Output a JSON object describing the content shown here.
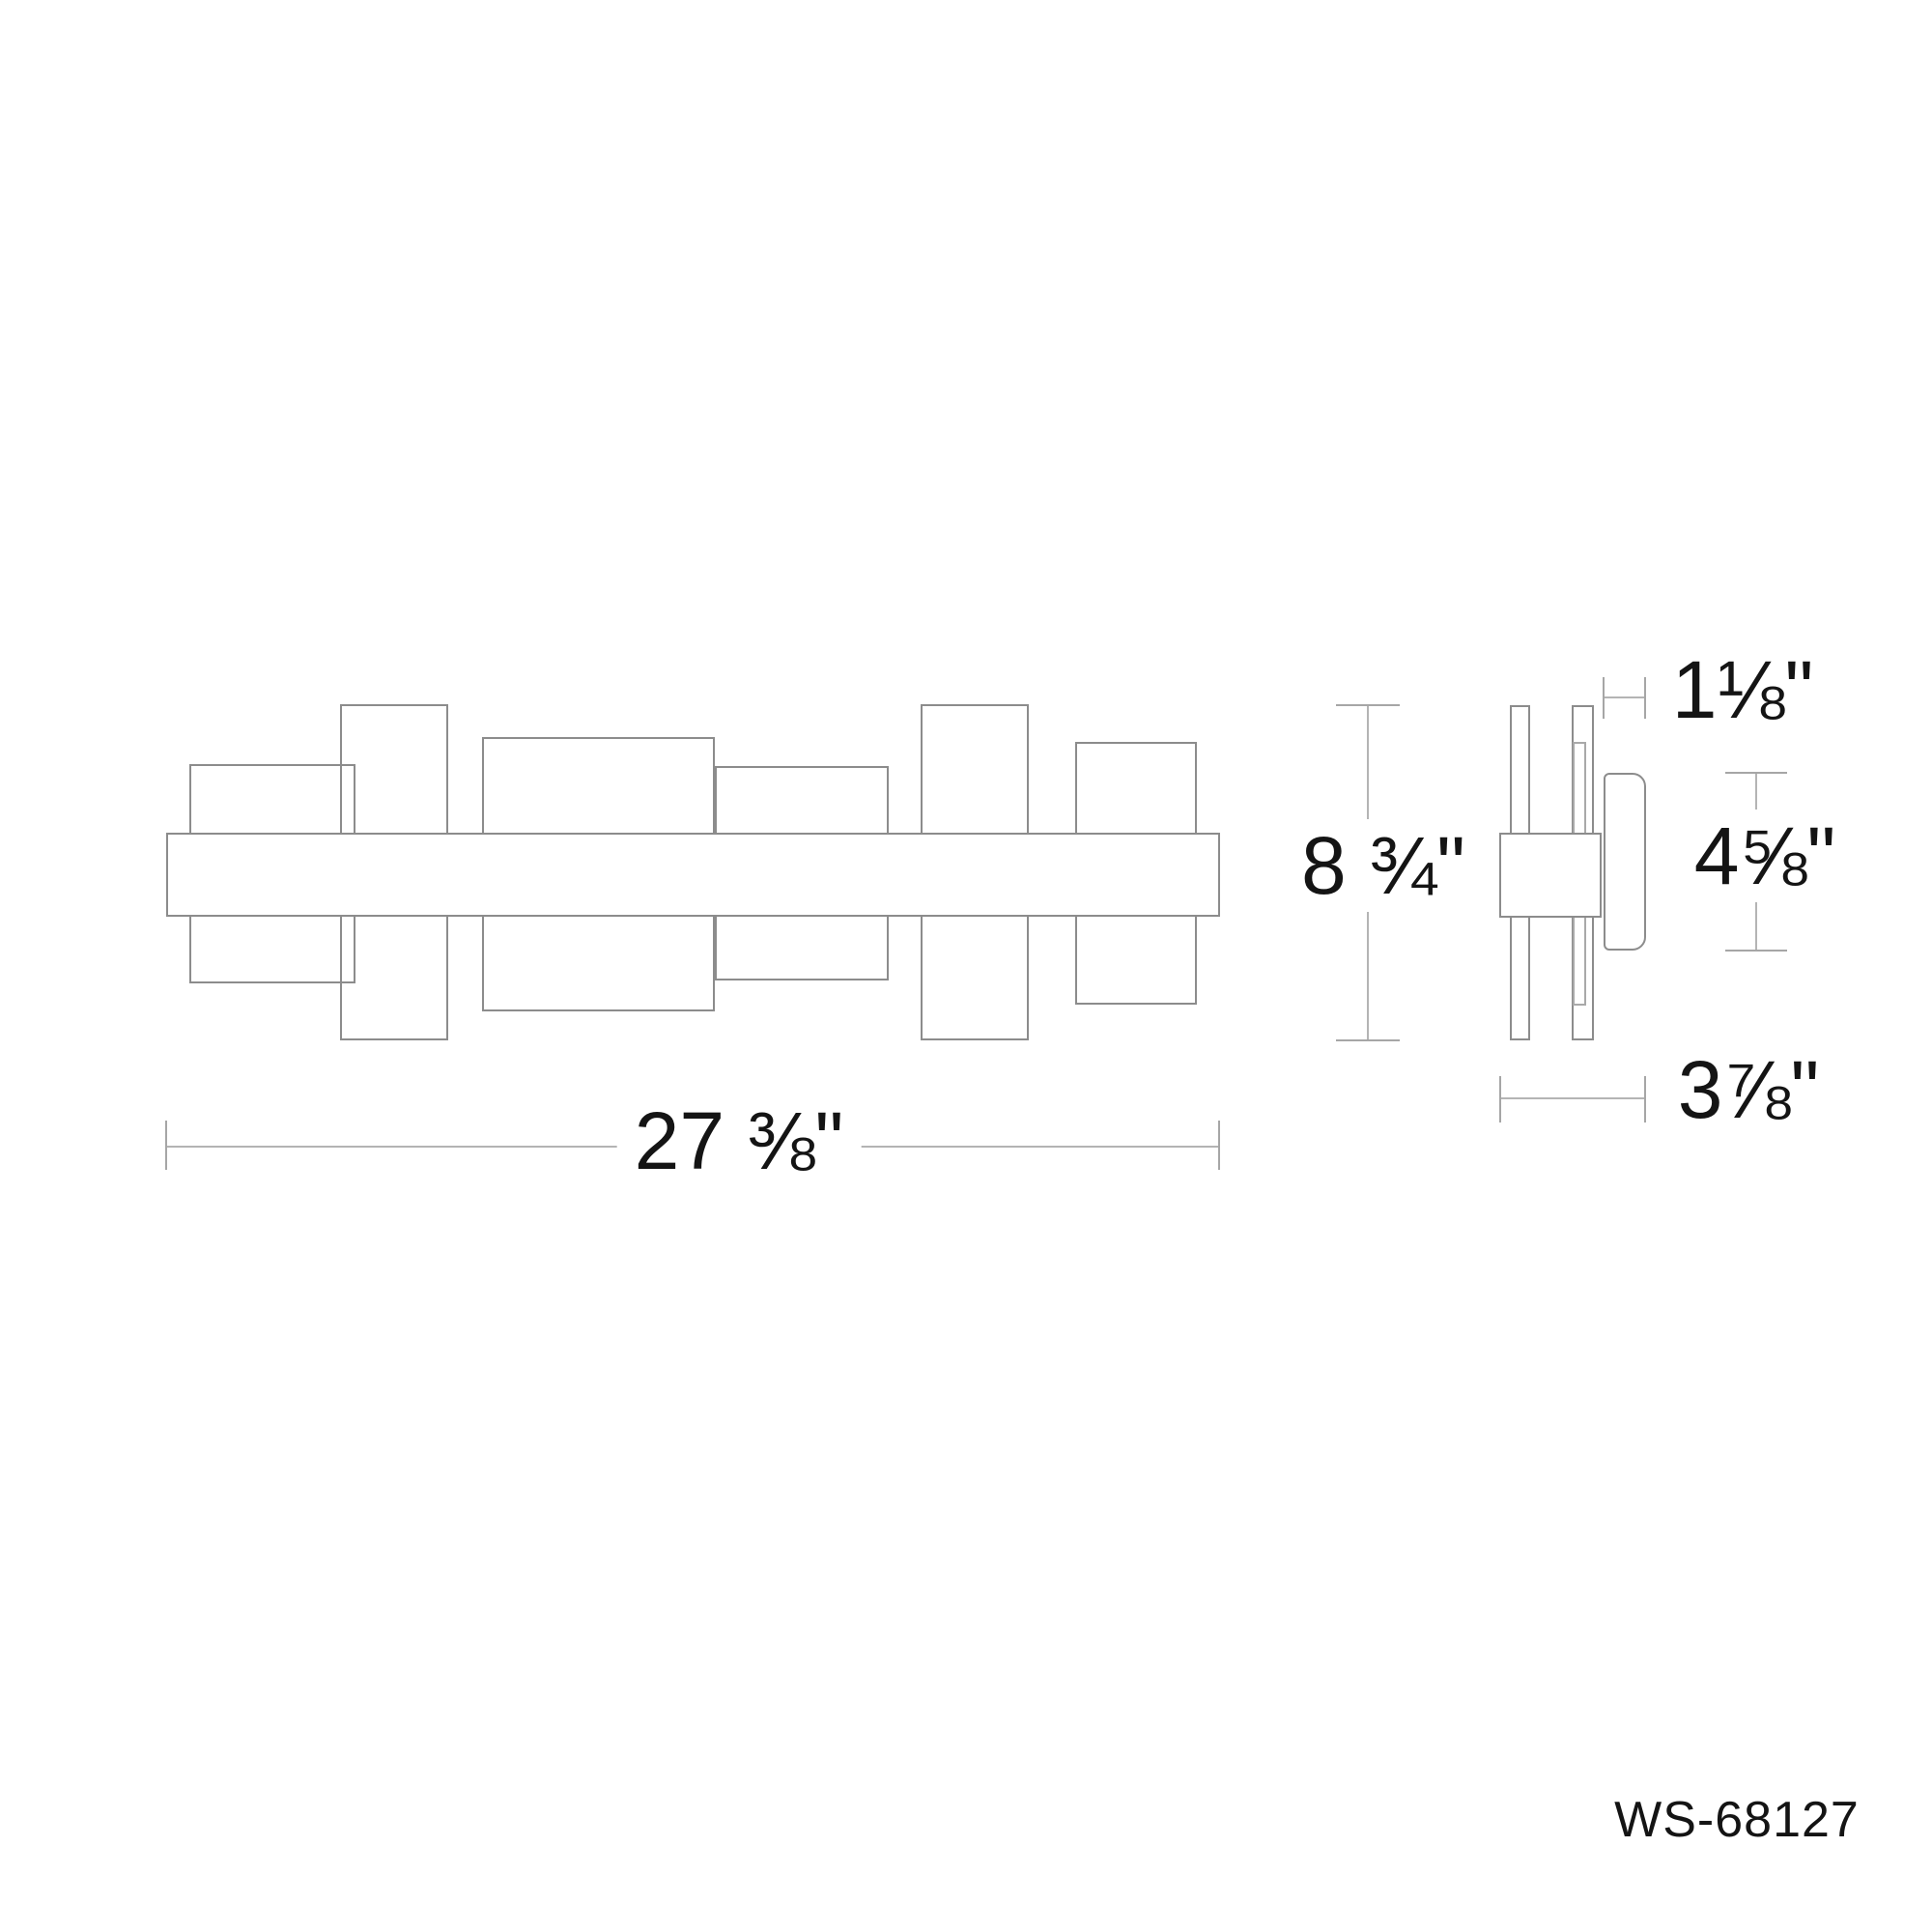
{
  "product_code": "WS-68127",
  "dimensions": {
    "overall_width": "27 ⅜\"",
    "overall_height": "8 ¾\"",
    "shade_depth": "1⅛\"",
    "shade_height": "4⅝\"",
    "overall_depth": "3⅞\""
  },
  "colors": {
    "line": "#8c8c8c",
    "line_light": "#a9a9a9",
    "dim_line": "#b4b4b4",
    "tick": "#a6a6a6",
    "text": "#141414",
    "background": "#ffffff"
  }
}
